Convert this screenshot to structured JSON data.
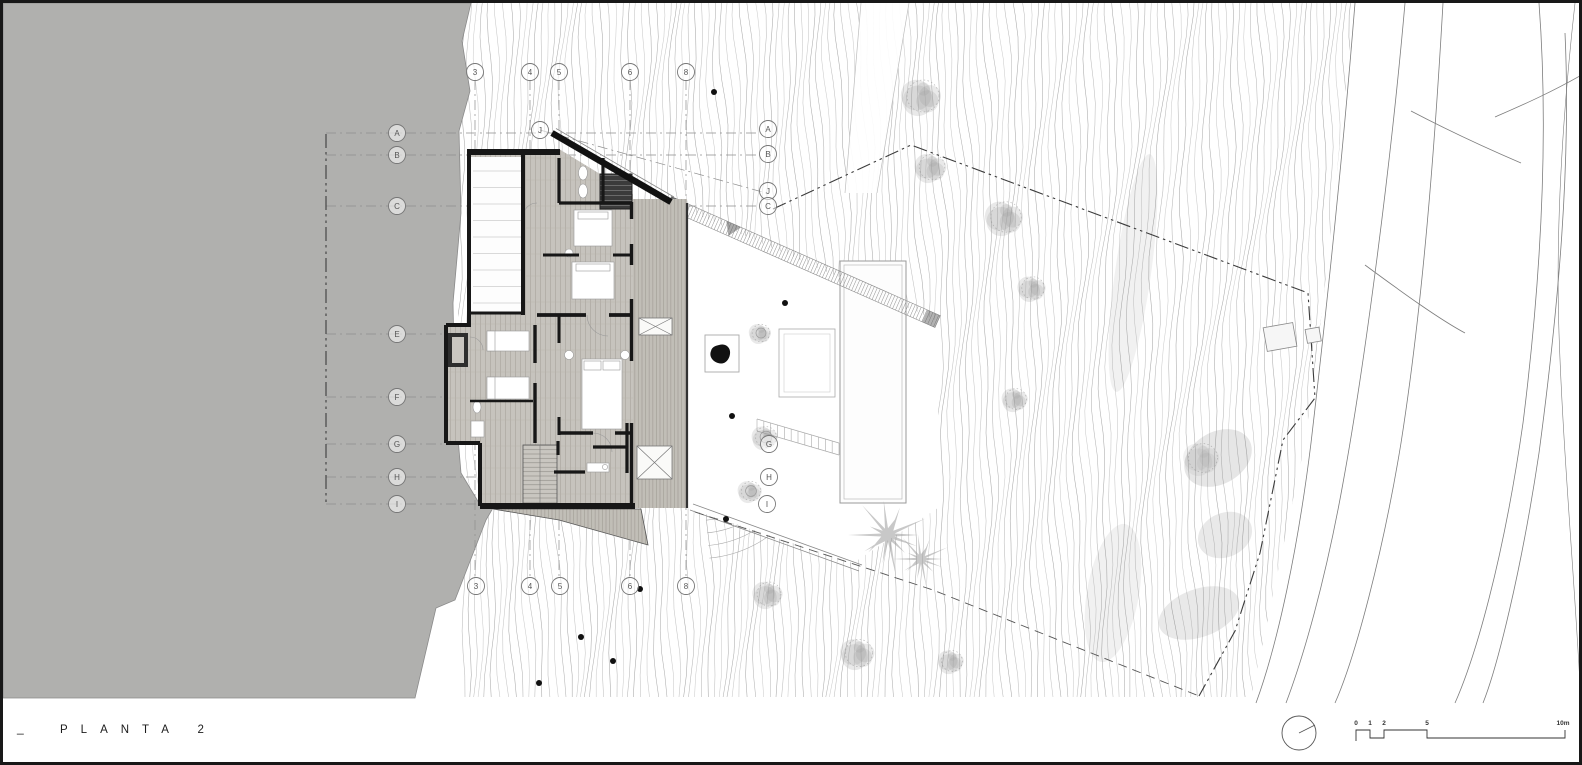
{
  "titleblock": {
    "prefix": "_",
    "title": "PLANTA 2"
  },
  "scalebar": {
    "ticks": [
      {
        "label": "0",
        "x": 1353
      },
      {
        "label": "1",
        "x": 1367
      },
      {
        "label": "2",
        "x": 1381
      },
      {
        "label": "5",
        "x": 1424
      },
      {
        "label": "10m",
        "x": 1560
      }
    ],
    "bar_path": "M1353,738 L1353,727 L1367,727 L1367,735 L1381,735 L1381,727 L1424,727 L1424,735 L1562,735 L1562,727"
  },
  "north_symbol": {
    "cx": 1296,
    "cy": 730,
    "r": 17,
    "needle_x2": 1312,
    "needle_y2": 722
  },
  "grid": {
    "markers_left": [
      {
        "label": "A",
        "x": 394,
        "y": 130
      },
      {
        "label": "B",
        "x": 394,
        "y": 152
      },
      {
        "label": "C",
        "x": 394,
        "y": 203
      },
      {
        "label": "E",
        "x": 394,
        "y": 331
      },
      {
        "label": "F",
        "x": 394,
        "y": 394
      },
      {
        "label": "G",
        "x": 394,
        "y": 441
      },
      {
        "label": "H",
        "x": 394,
        "y": 474
      },
      {
        "label": "I",
        "x": 394,
        "y": 501
      }
    ],
    "markers_right": [
      {
        "label": "A",
        "x": 765,
        "y": 126
      },
      {
        "label": "B",
        "x": 765,
        "y": 151
      },
      {
        "label": "J",
        "x": 765,
        "y": 188
      },
      {
        "label": "C",
        "x": 765,
        "y": 203
      },
      {
        "label": "G",
        "x": 766,
        "y": 441
      },
      {
        "label": "H",
        "x": 766,
        "y": 474
      },
      {
        "label": "I",
        "x": 764,
        "y": 501
      }
    ],
    "markers_top": [
      {
        "label": "3",
        "x": 472,
        "y": 69
      },
      {
        "label": "4",
        "x": 527,
        "y": 69
      },
      {
        "label": "5",
        "x": 556,
        "y": 69
      },
      {
        "label": "6",
        "x": 627,
        "y": 69
      },
      {
        "label": "8",
        "x": 683,
        "y": 69
      }
    ],
    "markers_bottom": [
      {
        "label": "3",
        "x": 473,
        "y": 583
      },
      {
        "label": "4",
        "x": 527,
        "y": 583
      },
      {
        "label": "5",
        "x": 557,
        "y": 583
      },
      {
        "label": "6",
        "x": 627,
        "y": 583
      },
      {
        "label": "8",
        "x": 683,
        "y": 583
      }
    ],
    "markers_extra": [
      {
        "label": "J",
        "x": 537,
        "y": 127
      }
    ],
    "lines_vertical": [
      472,
      527,
      556,
      627,
      683
    ],
    "v_y1": 77,
    "v_y2": 575,
    "lines_horizontal": [
      {
        "id": "A",
        "y": 130,
        "x1": 323,
        "x2": 756
      },
      {
        "id": "B",
        "y": 152,
        "x1": 323,
        "x2": 756
      },
      {
        "id": "C",
        "y": 203,
        "x1": 323,
        "x2": 757
      },
      {
        "id": "E",
        "y": 331,
        "x1": 323,
        "x2": 443
      },
      {
        "id": "F",
        "y": 394,
        "x1": 323,
        "x2": 443
      },
      {
        "id": "G",
        "y": 441,
        "x1": 323,
        "x2": 758
      },
      {
        "id": "H",
        "y": 474,
        "x1": 323,
        "x2": 758
      },
      {
        "id": "I",
        "y": 501,
        "x1": 323,
        "x2": 756
      }
    ],
    "lines_diagonal": [
      {
        "id": "J",
        "x1": 537,
        "y1": 127,
        "x2": 763,
        "y2": 190
      }
    ]
  },
  "site": {
    "boundary_main": "M770,206 L908,142 L1305,290 L1312,395 L1280,437 L1257,550 L1232,628 L1196,693",
    "boundary_left_x": 323,
    "boundary_left_y1": 131,
    "boundary_left_y2": 501,
    "path_dashed": "M692,509 L930,587 L1196,693",
    "trees_hill": [
      {
        "x": 920,
        "y": 93,
        "r": 20
      },
      {
        "x": 929,
        "y": 164,
        "r": 16
      },
      {
        "x": 1003,
        "y": 214,
        "r": 19
      },
      {
        "x": 1030,
        "y": 285,
        "r": 14
      },
      {
        "x": 1013,
        "y": 396,
        "r": 13
      },
      {
        "x": 766,
        "y": 591,
        "r": 15
      },
      {
        "x": 856,
        "y": 650,
        "r": 17
      },
      {
        "x": 949,
        "y": 658,
        "r": 13
      },
      {
        "x": 1200,
        "y": 455,
        "r": 18
      }
    ],
    "trees_terrace": [
      {
        "x": 758,
        "y": 330,
        "r": 11
      },
      {
        "x": 763,
        "y": 434,
        "r": 13
      },
      {
        "x": 748,
        "y": 488,
        "r": 12
      }
    ],
    "palms": [
      {
        "x": 885,
        "y": 532,
        "r": 38
      },
      {
        "x": 918,
        "y": 556,
        "r": 27
      }
    ],
    "dots": [
      [
        711,
        89
      ],
      [
        782,
        300
      ],
      [
        729,
        413
      ],
      [
        723,
        516
      ],
      [
        637,
        586
      ],
      [
        578,
        634
      ],
      [
        610,
        658
      ],
      [
        536,
        680
      ]
    ]
  },
  "colors": {
    "land_gray": "#b0b0ae",
    "contour": "#a2a2a2",
    "wall": "#171717",
    "boundary": "#3c3c3c",
    "grid_line": "#8d8d8d",
    "floor_wood": "#c6c3bd",
    "deck_wood": "#c1beb7"
  }
}
